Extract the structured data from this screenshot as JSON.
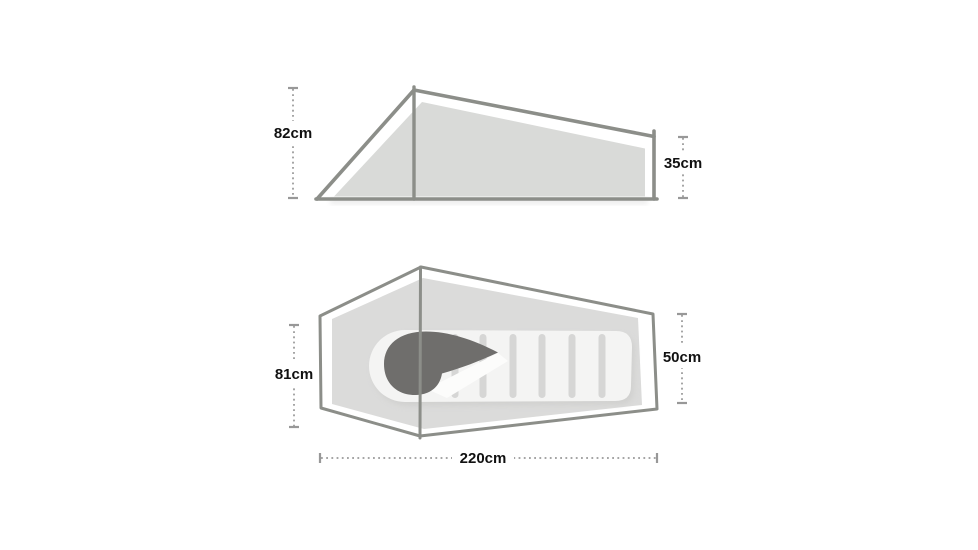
{
  "page": {
    "description": "Tent dimensions diagram with side elevation and floor plan views",
    "background": "#ffffff"
  },
  "colors": {
    "outline_stroke": "#8c8e89",
    "canvas_fill": "#d9dad8",
    "footprint_fill": "#dbdbda",
    "sleeping_pad_fill": "#f4f4f3",
    "pad_shadow": "#c9c9c7",
    "baffle_fill": "#d6d6d5",
    "hood_fill": "#6f6e6c",
    "wedge_highlight": "#fcfcfb",
    "dimension_line": "#a5a5a5",
    "label_text": "#111111"
  },
  "side_view": {
    "name": "tent side elevation",
    "dimensions": [
      {
        "id": "peak-height",
        "label": "82cm"
      },
      {
        "id": "foot-height",
        "label": "35cm"
      }
    ]
  },
  "top_view": {
    "name": "tent floor plan",
    "dimensions": [
      {
        "id": "head-width",
        "label": "81cm"
      },
      {
        "id": "foot-width",
        "label": "50cm"
      },
      {
        "id": "length",
        "label": "220cm"
      }
    ]
  }
}
